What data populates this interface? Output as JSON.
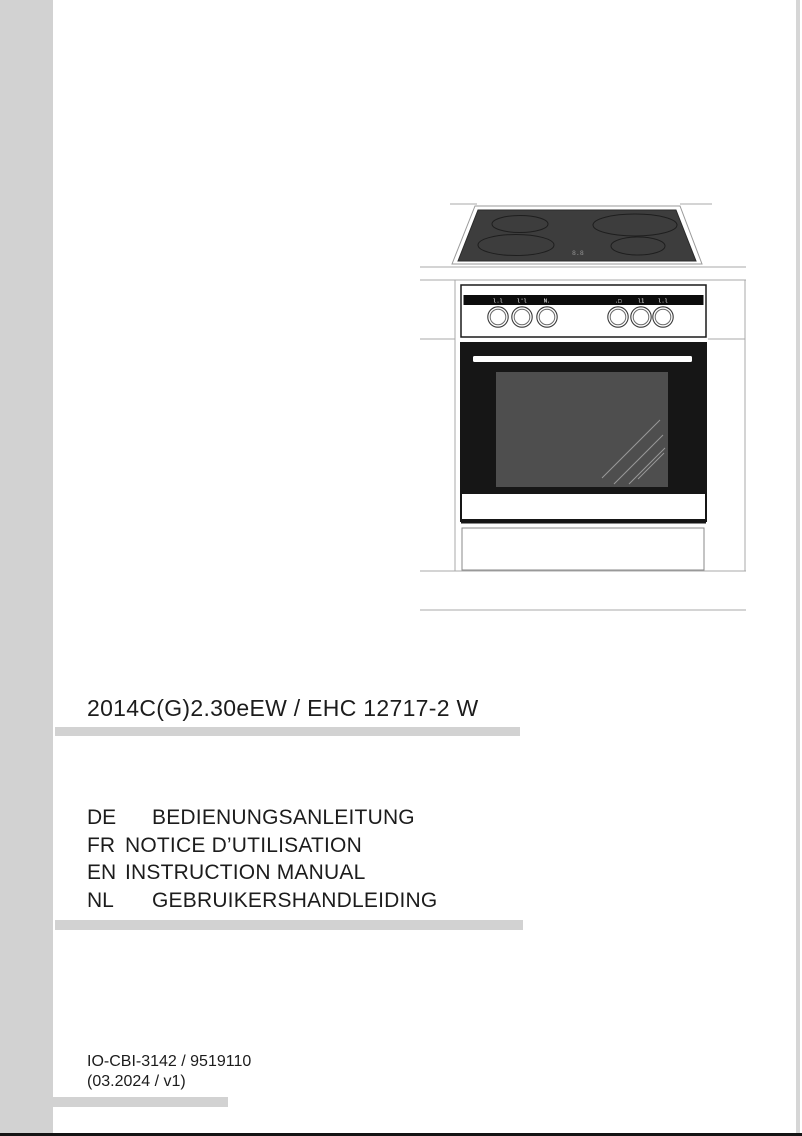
{
  "page": {
    "model_title": "2014C(G)2.30eEW / EHC 12717-2 W",
    "languages": [
      {
        "code": "DE",
        "label": "BEDIENUNGSANLEITUNG"
      },
      {
        "code": "FR",
        "label": "NOTICE D’UTILISATION"
      },
      {
        "code": "EN",
        "label": "INSTRUCTION MANUAL"
      },
      {
        "code": "NL",
        "label": "GEBRUIKERSHANDLEIDING"
      }
    ],
    "footer": {
      "doc_code": "IO-CBI-3142 / 9519110",
      "revision": "(03.2024 / v1)"
    }
  },
  "illustration": {
    "description": "line drawing of freestanding cooker with ceramic hob, control panel with six knobs, oven door and plinth drawer",
    "hob_display": "8.8",
    "knob_icons": [
      {
        "name": "hotplate-front-left-icon",
        "glyph": "l.l"
      },
      {
        "name": "hotplate-back-left-icon",
        "glyph": "l'l"
      },
      {
        "name": "hotplate-right-icon",
        "glyph": "N."
      },
      {
        "name": "oven-light-icon",
        "glyph": ".□"
      },
      {
        "name": "oven-temperature-icon",
        "glyph": "l1"
      },
      {
        "name": "oven-function-icon",
        "glyph": "l.l"
      }
    ]
  },
  "colors": {
    "band_gray": "#d2d2d2",
    "line_gray": "#a8a8a8",
    "appliance_black": "#161616",
    "hob_glass": "#3d3d3d",
    "oven_window": "#4e4e4e",
    "page_bottom_border": "#141414"
  }
}
